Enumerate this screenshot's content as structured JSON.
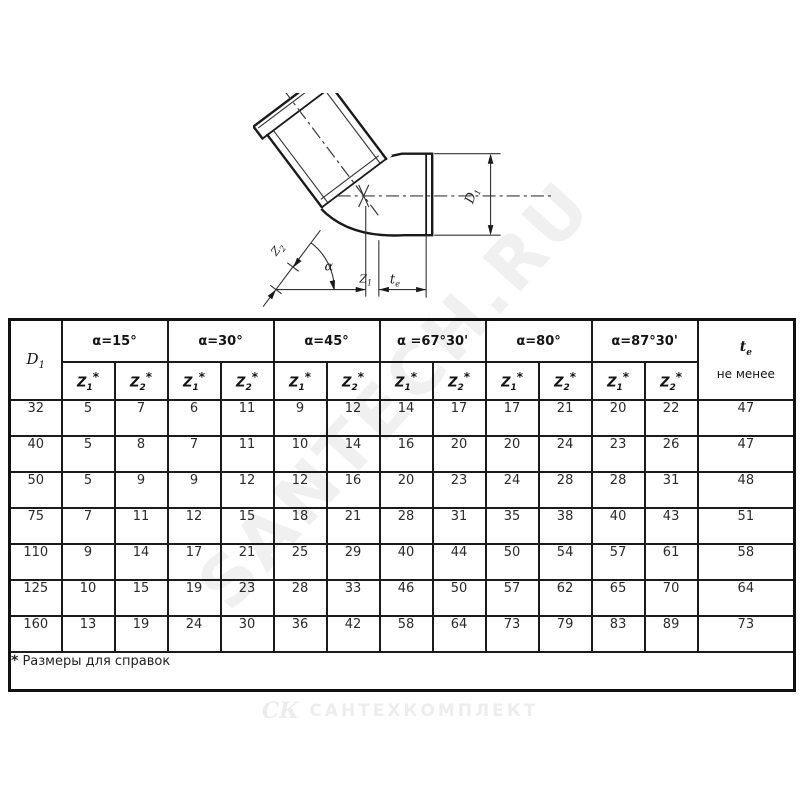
{
  "watermark": "SANTECH.RU",
  "footer_logo": {
    "mark": "СК",
    "text": "САНТЕХКОМПЛЕКТ"
  },
  "drawing": {
    "labels": {
      "z2": {
        "base": "Z",
        "sub": "2"
      },
      "alpha": "α",
      "z1": {
        "base": "Z",
        "sub": "1"
      },
      "te": {
        "base": "t",
        "sub": "e"
      },
      "d1": {
        "base": "D",
        "sub": "1"
      }
    }
  },
  "table": {
    "d1_header": {
      "base": "D",
      "sub": "1"
    },
    "angle_groups": [
      "α=15°",
      "α=30°",
      "α=45°",
      "α =67°30'",
      "α=80°",
      "α=87°30'"
    ],
    "z1_header": {
      "base": "Z",
      "sub": "1",
      "mark": "*"
    },
    "z2_header": {
      "base": "Z",
      "sub": "2",
      "mark": "*"
    },
    "te_header": {
      "base": "t",
      "sub": "e",
      "note": "не менее"
    },
    "rows": [
      {
        "d1": "32",
        "values": [
          5,
          7,
          6,
          11,
          9,
          12,
          14,
          17,
          17,
          21,
          20,
          22
        ],
        "te": 47
      },
      {
        "d1": "40",
        "values": [
          5,
          8,
          7,
          11,
          10,
          14,
          16,
          20,
          20,
          24,
          23,
          26
        ],
        "te": 47
      },
      {
        "d1": "50",
        "values": [
          5,
          9,
          9,
          12,
          12,
          16,
          20,
          23,
          24,
          28,
          28,
          31
        ],
        "te": 48
      },
      {
        "d1": "75",
        "values": [
          7,
          11,
          12,
          15,
          18,
          21,
          28,
          31,
          35,
          38,
          40,
          43
        ],
        "te": 51
      },
      {
        "d1": "110",
        "values": [
          9,
          14,
          17,
          21,
          25,
          29,
          40,
          44,
          50,
          54,
          57,
          61
        ],
        "te": 58
      },
      {
        "d1": "125",
        "values": [
          10,
          15,
          19,
          23,
          28,
          33,
          46,
          50,
          57,
          62,
          65,
          70
        ],
        "te": 64
      },
      {
        "d1": "160",
        "values": [
          13,
          19,
          24,
          30,
          36,
          42,
          58,
          64,
          73,
          79,
          83,
          89
        ],
        "te": 73
      }
    ],
    "footnote": {
      "mark": "*",
      "text": "Размеры для справок"
    }
  }
}
